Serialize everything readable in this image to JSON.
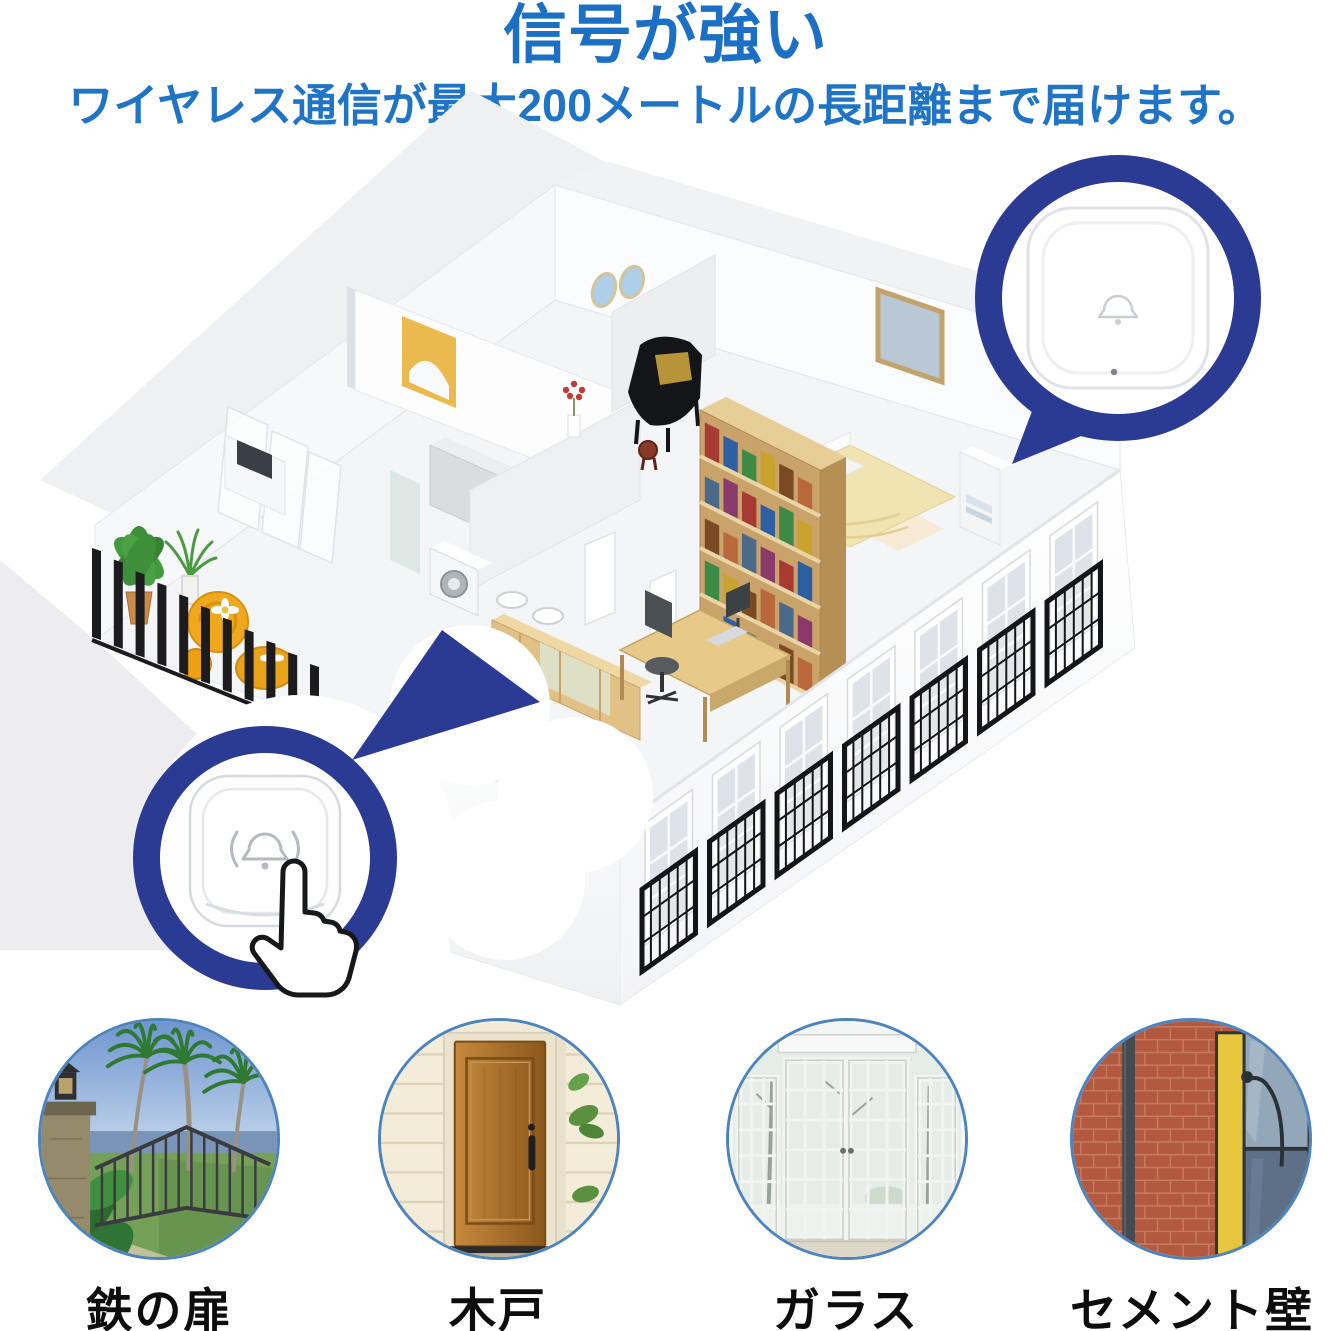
{
  "header": {
    "title": "信号が強い",
    "subtitle": "ワイヤレス通信が最大200メートルの長距離まで届けます。"
  },
  "callouts": {
    "receiver": {
      "icon": "bell-icon",
      "device": "chime-receiver"
    },
    "button": {
      "icon": "bell-ring-icon",
      "cursor": "hand-cursor-icon",
      "device": "doorbell-push-button"
    }
  },
  "materials": {
    "items": [
      {
        "label": "鉄の扉",
        "photo": "iron-gate"
      },
      {
        "label": "木戸",
        "photo": "wooden-door"
      },
      {
        "label": "ガラス",
        "photo": "glass-french-doors"
      },
      {
        "label": "セメント壁",
        "photo": "brick-cement-wall"
      }
    ]
  },
  "colors": {
    "title_blue": "#1b70c6",
    "subtitle_blue": "#1f74c6",
    "ring_navy": "#2b3b94",
    "photo_border_blue": "#4d84bd"
  }
}
